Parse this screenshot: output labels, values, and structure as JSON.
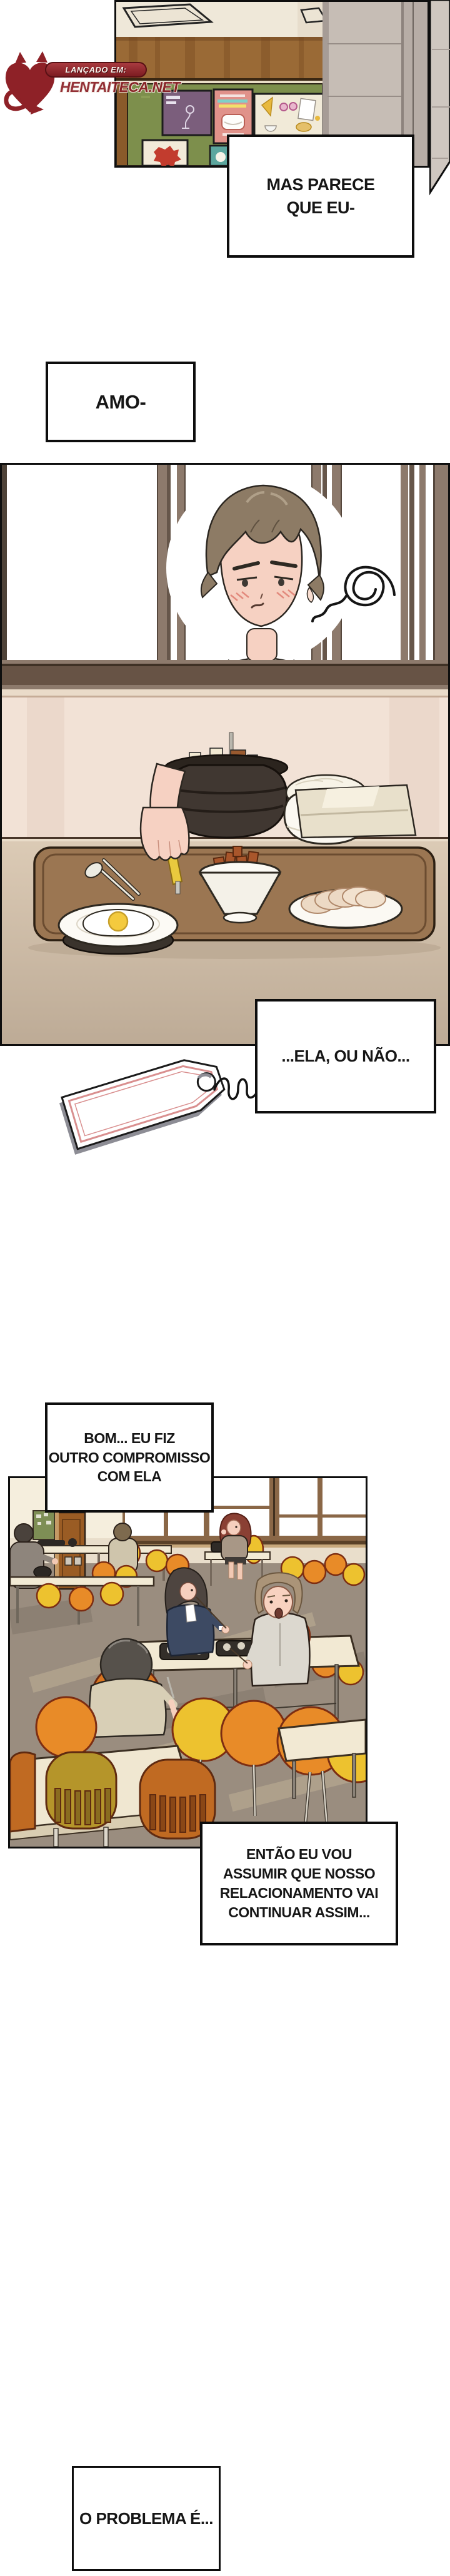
{
  "watermark": {
    "label": "LANÇADO EM:",
    "site": "HENTAITECA.NET"
  },
  "speech": {
    "b1": {
      "lines": [
        "MAS PARECE",
        "QUE EU-"
      ]
    },
    "b2": {
      "lines": [
        "AMO-"
      ]
    },
    "b3": {
      "lines": [
        "...ELA, OU NÃO..."
      ]
    },
    "b4": {
      "lines": [
        "BOM... EU FIZ",
        "OUTRO COMPROMISSO",
        "COM ELA"
      ]
    },
    "b5": {
      "lines": [
        "ENTÃO EU VOU",
        "ASSUMIR QUE NOSSO",
        "RELACIONAMENTO VAI",
        "CONTINUAR ASSIM..."
      ]
    },
    "b6": {
      "lines": [
        "O PROBLEMA É..."
      ]
    }
  },
  "poster": {
    "club_line1": "창업",
    "club_line2": "동아리 모집"
  },
  "colors": {
    "logo_red": "#8e2127",
    "board_green": "#7d8f4c",
    "chair_yellow": "#edc22f",
    "chair_orange": "#e88b28",
    "wood_band": "#9a6a36",
    "panel_border": "#0e0e0e"
  }
}
